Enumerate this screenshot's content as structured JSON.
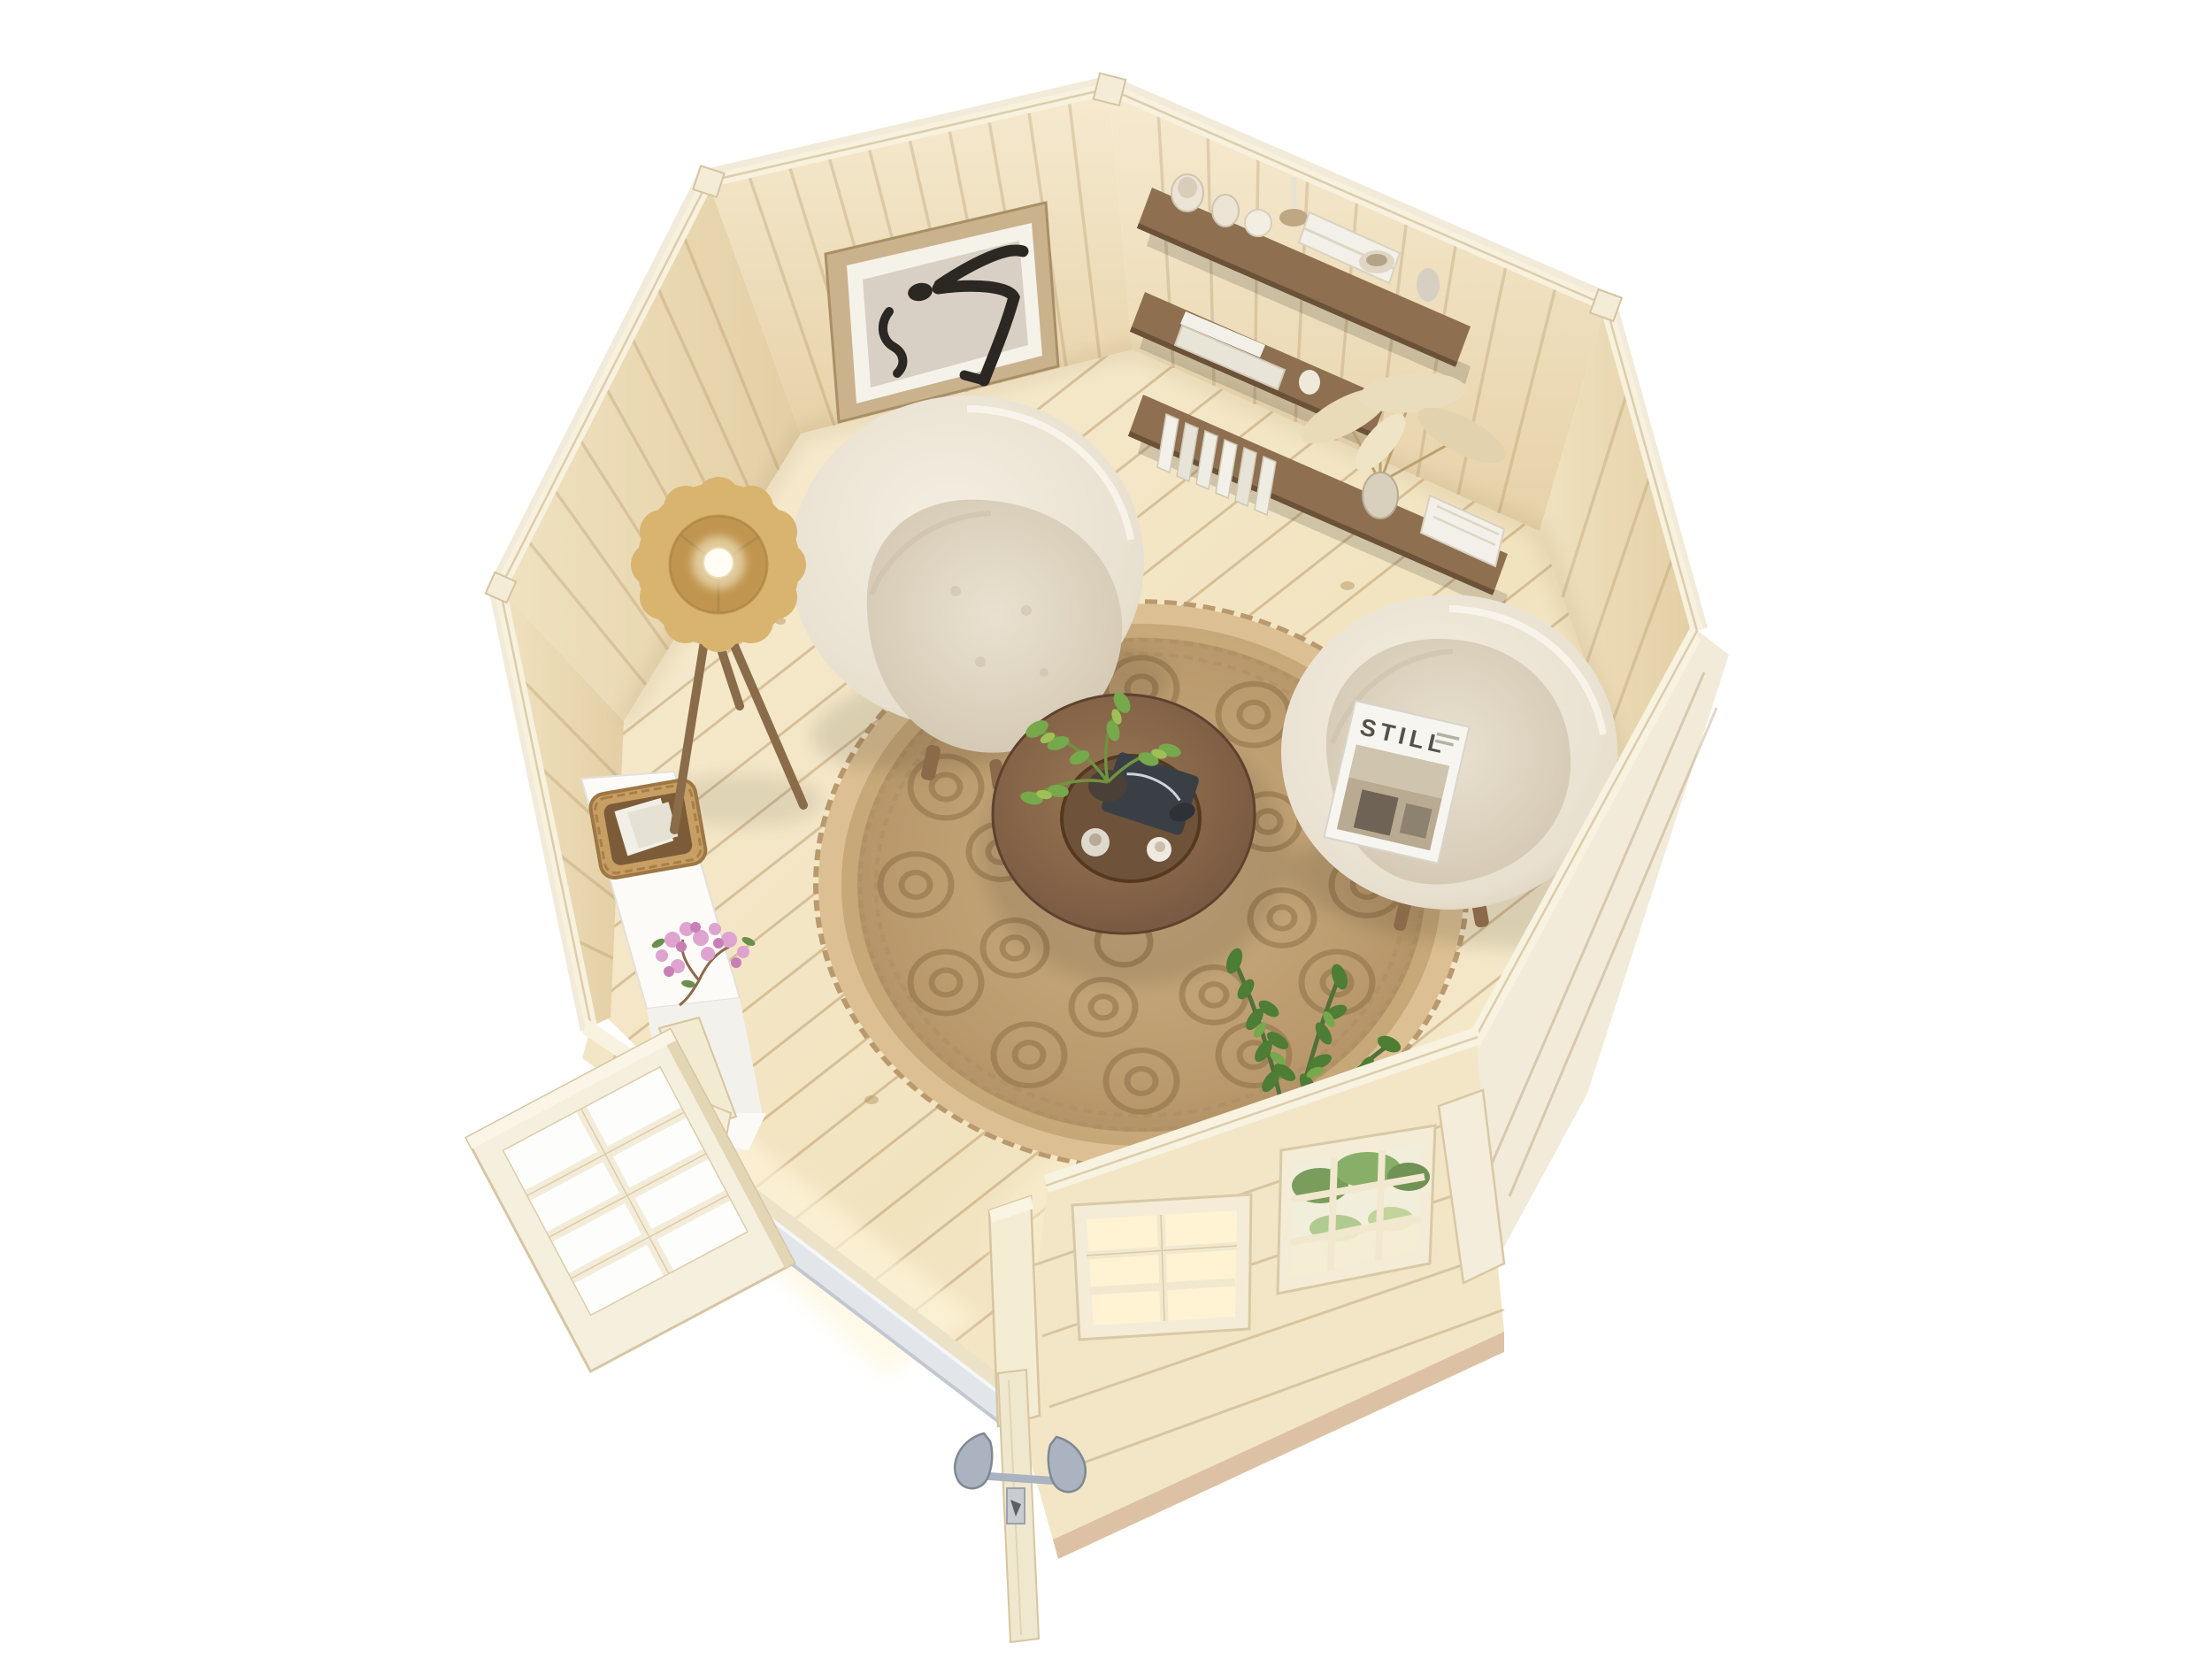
{
  "scene": {
    "alt": "Bird's-eye 3D render of an octagonal wooden garden cabin interior with two cream boucle armchairs, a round jute rug, a walnut coffee table, a floor lamp, wall shelves with books and vases, an abstract framed print, an open glazed double door and two front windows",
    "background": "#ffffff"
  },
  "magazine": {
    "title": "STILL"
  },
  "objects": {
    "cabin": "octagonal log cabin seen from above",
    "floor": "light pine plank floor laid diagonally",
    "rug": "round braided jute rug with spiral rosettes",
    "armchair_left": "cream boucle swivel armchair",
    "armchair_right": "cream boucle swivel armchair with magazine",
    "magazine": "STILL magazine on chair seat",
    "coffee_table": "round walnut coffee table with recessed tray, candles and green plant",
    "floor_lamp": "tripod floor lamp with scalloped rattan shade and glowing bulb",
    "shelf_unit": "three stepped walnut wall shelves with white books, vases and pampas grass",
    "art_frame": "framed abstract black brush-stroke print",
    "console_table": "white console table with woven basket of books and pink blossom stems",
    "zz_plant": "green zamioculcas plant by the front window",
    "open_door": "glazed door leaf with eight panes swung open",
    "door_edge": "second door leaf seen edge-on with lever handles",
    "window_left": "six-pane front window",
    "window_right": "nine-pane front window with greenery behind the glass",
    "threshold": "aluminium door threshold"
  },
  "palette": {
    "floor_base": "#f4e7c8",
    "wall_base": "#efe0ba",
    "wall_alt": "#f2e6c6",
    "wall_top": "#f8f2e0",
    "wall_exterior": "#f2ebd9",
    "base_strip": "#ddc1a4",
    "rug_base": "#c0a176",
    "rug_rosette": "#8f7148",
    "chair_boucle": "#eee8da",
    "chair_seat": "#e0d7c4",
    "table_walnut": "#8c6c4c",
    "table_tray": "#6f523a",
    "lamp_shade": "#d9b46f",
    "lamp_inner": "#c0954f",
    "shelf_wood": "#8e7051",
    "book_white": "#f3f0e9",
    "plant_green": "#4e7d35",
    "plant_green_light": "#76a84c",
    "blossom_pink": "#dfa3cf",
    "handle_metal": "#aab3bf",
    "glass_warm": "#fff3d4",
    "magazine_ink": "#55504a"
  }
}
